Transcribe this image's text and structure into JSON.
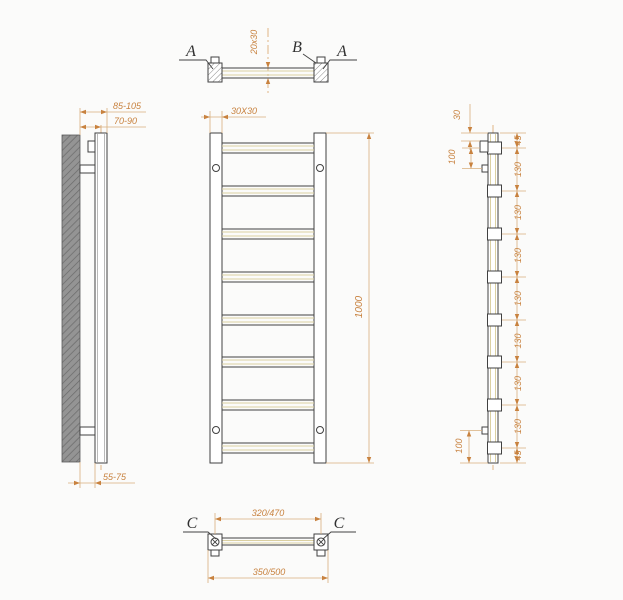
{
  "drawing": {
    "title": "towel-rail-technical-drawing",
    "colors": {
      "line": "#414141",
      "dimension_line": "#d9af7c",
      "dimension_text": "#c8823f",
      "tube_inner": "#dbd0a2",
      "wall_fill": "#949494",
      "wall_hatch": "#6a6a6a",
      "background": "#fbfbfa"
    },
    "top_view": {
      "section_label_left": "A",
      "section_label_mid": "B",
      "section_label_right": "A",
      "dim_tube": "20x30"
    },
    "left_view": {
      "dim_max": "85-105",
      "dim_mid": "70-90",
      "dim_min": "55-75"
    },
    "front_view": {
      "dim_post": "30X30",
      "dim_height": "1000"
    },
    "right_view": {
      "dim_top_offset": "30",
      "dim_bracket_top": "100",
      "dim_bracket_bottom": "100",
      "chain": [
        "45",
        "130",
        "130",
        "130",
        "130",
        "130",
        "130",
        "130",
        "45"
      ]
    },
    "bottom_view": {
      "section_label_left": "C",
      "section_label_right": "C",
      "dim_inner": "320/470",
      "dim_outer": "350/500"
    }
  }
}
